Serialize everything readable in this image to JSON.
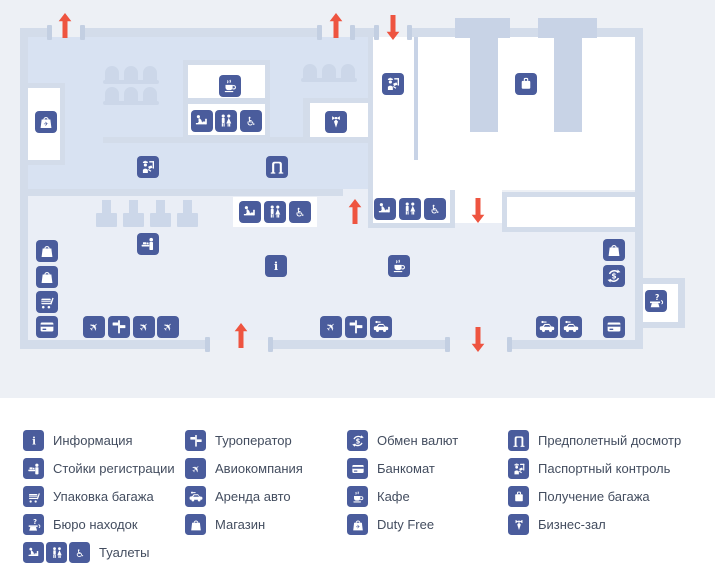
{
  "title": "Схема терминала аэропорта",
  "palette": {
    "icon_blue": "#4a5c9c",
    "arrow_red": "#ee5440",
    "wall": "#d3dcea",
    "hall_blue_floor": "#d8e2f2",
    "hall_gray_floor": "#eaeef6",
    "white_room": "#ffffff",
    "map_background": "#edf0f5",
    "legend_text": "#434d5f"
  },
  "legend": {
    "columns": [
      {
        "items": [
          {
            "icons": [
              "info"
            ],
            "label": "Информация"
          },
          {
            "icons": [
              "registration"
            ],
            "label": "Стойки регистрации"
          },
          {
            "icons": [
              "packing"
            ],
            "label": "Упаковка багажа"
          },
          {
            "icons": [
              "lostfound"
            ],
            "label": "Бюро находок"
          },
          {
            "icons": [
              "baby",
              "wc",
              "wheelchair"
            ],
            "label": "Туалеты"
          }
        ]
      },
      {
        "items": [
          {
            "icons": [
              "tourop"
            ],
            "label": "Туроператор"
          },
          {
            "icons": [
              "plane"
            ],
            "label": "Авиокомпания"
          },
          {
            "icons": [
              "car"
            ],
            "label": "Аренда авто"
          },
          {
            "icons": [
              "shop"
            ],
            "label": "Магазин"
          }
        ]
      },
      {
        "items": [
          {
            "icons": [
              "exchange"
            ],
            "label": "Обмен валют"
          },
          {
            "icons": [
              "atm"
            ],
            "label": "Банкомат"
          },
          {
            "icons": [
              "cafe"
            ],
            "label": "Кафе"
          },
          {
            "icons": [
              "dutyfree"
            ],
            "label": "Duty Free"
          }
        ]
      },
      {
        "items": [
          {
            "icons": [
              "security"
            ],
            "label": "Предполетный досмотр"
          },
          {
            "icons": [
              "passport"
            ],
            "label": "Паспортный контроль"
          },
          {
            "icons": [
              "baggage"
            ],
            "label": "Получение багажа"
          },
          {
            "icons": [
              "business"
            ],
            "label": "Бизнес-зал"
          }
        ]
      }
    ]
  },
  "plan": {
    "icons": [
      {
        "type": "dutyfree",
        "x": 35,
        "y": 111
      },
      {
        "type": "cafe",
        "x": 219,
        "y": 75
      },
      {
        "type": "baby",
        "x": 191,
        "y": 110
      },
      {
        "type": "wc",
        "x": 215,
        "y": 110
      },
      {
        "type": "wheelchair",
        "x": 240,
        "y": 110
      },
      {
        "type": "business",
        "x": 325,
        "y": 111
      },
      {
        "type": "passport",
        "x": 137,
        "y": 156
      },
      {
        "type": "security",
        "x": 266,
        "y": 156
      },
      {
        "type": "passport",
        "x": 382,
        "y": 73
      },
      {
        "type": "baggage",
        "x": 515,
        "y": 73
      },
      {
        "type": "baby",
        "x": 239,
        "y": 201
      },
      {
        "type": "wc",
        "x": 264,
        "y": 201
      },
      {
        "type": "wheelchair",
        "x": 289,
        "y": 201
      },
      {
        "type": "baby",
        "x": 374,
        "y": 198
      },
      {
        "type": "wc",
        "x": 399,
        "y": 198
      },
      {
        "type": "wheelchair",
        "x": 424,
        "y": 198
      },
      {
        "type": "registration",
        "x": 137,
        "y": 233
      },
      {
        "type": "info",
        "x": 265,
        "y": 255
      },
      {
        "type": "shop",
        "x": 36,
        "y": 240
      },
      {
        "type": "shop",
        "x": 36,
        "y": 266
      },
      {
        "type": "packing",
        "x": 36,
        "y": 291
      },
      {
        "type": "atm",
        "x": 36,
        "y": 316
      },
      {
        "type": "plane",
        "x": 83,
        "y": 316
      },
      {
        "type": "tourop",
        "x": 108,
        "y": 316
      },
      {
        "type": "plane",
        "x": 133,
        "y": 316
      },
      {
        "type": "plane",
        "x": 157,
        "y": 316
      },
      {
        "type": "plane",
        "x": 320,
        "y": 316
      },
      {
        "type": "tourop",
        "x": 345,
        "y": 316
      },
      {
        "type": "car",
        "x": 370,
        "y": 316
      },
      {
        "type": "cafe",
        "x": 388,
        "y": 255
      },
      {
        "type": "shop",
        "x": 603,
        "y": 239
      },
      {
        "type": "exchange",
        "x": 603,
        "y": 265
      },
      {
        "type": "atm",
        "x": 603,
        "y": 316
      },
      {
        "type": "car",
        "x": 536,
        "y": 316
      },
      {
        "type": "car",
        "x": 560,
        "y": 316
      },
      {
        "type": "lostfound",
        "x": 645,
        "y": 290
      }
    ],
    "arrows": [
      {
        "dir": "up",
        "x": 58,
        "y": 13
      },
      {
        "dir": "up",
        "x": 329,
        "y": 13
      },
      {
        "dir": "down",
        "x": 386,
        "y": 15
      },
      {
        "dir": "up",
        "x": 348,
        "y": 199
      },
      {
        "dir": "down",
        "x": 471,
        "y": 198
      },
      {
        "dir": "up",
        "x": 234,
        "y": 323
      },
      {
        "dir": "down",
        "x": 471,
        "y": 327
      }
    ]
  }
}
